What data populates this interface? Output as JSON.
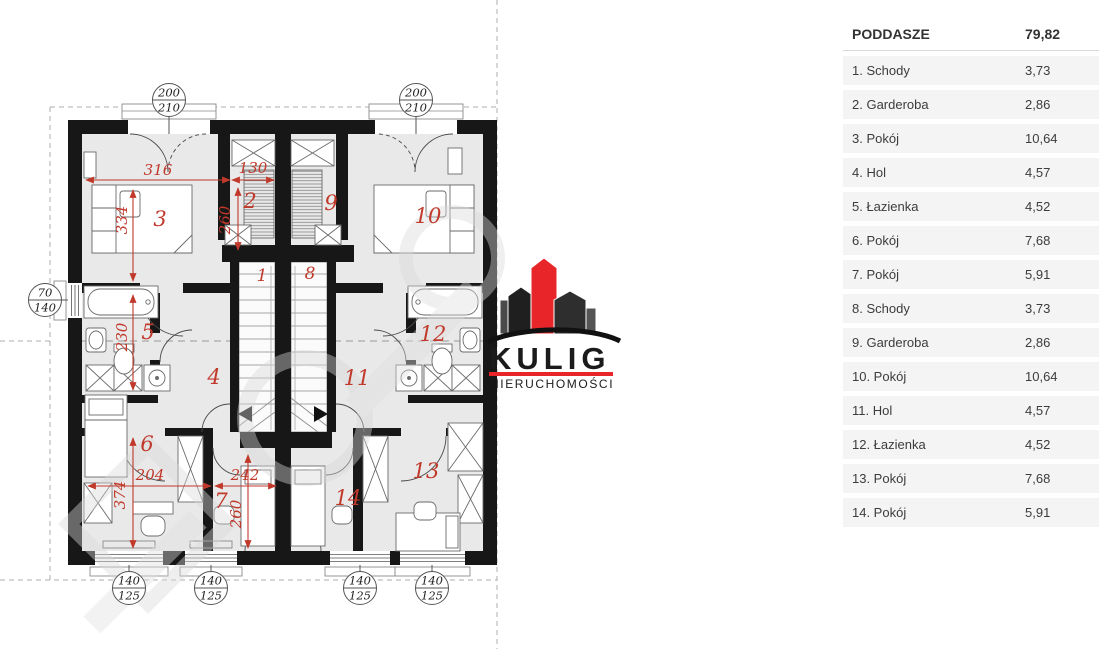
{
  "table": {
    "header": {
      "label": "PODDASZE",
      "value": "79,82"
    },
    "rows": [
      {
        "label": "1. Schody",
        "value": "3,73"
      },
      {
        "label": "2. Garderoba",
        "value": "2,86"
      },
      {
        "label": "3. Pokój",
        "value": "10,64"
      },
      {
        "label": "4. Hol",
        "value": "4,57"
      },
      {
        "label": "5. Łazienka",
        "value": "4,52"
      },
      {
        "label": "6. Pokój",
        "value": "7,68"
      },
      {
        "label": "7. Pokój",
        "value": "5,91"
      },
      {
        "label": "8. Schody",
        "value": "3,73"
      },
      {
        "label": "9. Garderoba",
        "value": "2,86"
      },
      {
        "label": "10. Pokój",
        "value": "10,64"
      },
      {
        "label": "11. Hol",
        "value": "4,57"
      },
      {
        "label": "12. Łazienka",
        "value": "4,52"
      },
      {
        "label": "13. Pokój",
        "value": "7,68"
      },
      {
        "label": "14. Pokój",
        "value": "5,91"
      }
    ]
  },
  "logo": {
    "name": "KULIG",
    "subtitle": "NIERUCHOMOŚCI"
  },
  "plan": {
    "rooms": [
      "1",
      "2",
      "3",
      "4",
      "5",
      "6",
      "7",
      "8",
      "9",
      "10",
      "11",
      "12",
      "13",
      "14"
    ],
    "dims": [
      "316",
      "130",
      "260",
      "334",
      "230",
      "374",
      "204",
      "242",
      "260"
    ],
    "bubbles": [
      {
        "top": "200",
        "bottom": "210"
      },
      {
        "top": "200",
        "bottom": "210"
      },
      {
        "top": "70",
        "bottom": "140"
      },
      {
        "top": "140",
        "bottom": "125"
      },
      {
        "top": "140",
        "bottom": "125"
      },
      {
        "top": "140",
        "bottom": "125"
      },
      {
        "top": "140",
        "bottom": "125"
      }
    ]
  },
  "colors": {
    "wall": "#171717",
    "floor": "#e9e9e9",
    "dimension_red": "#c0392b",
    "logo_red": "#e8262a",
    "row_bg": "#f4f4f4"
  }
}
